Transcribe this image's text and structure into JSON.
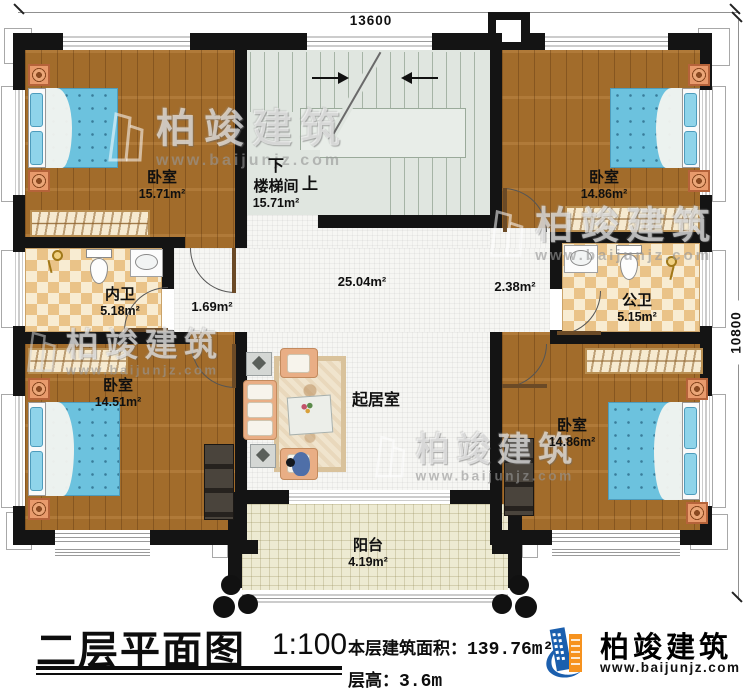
{
  "dimensions": {
    "width_top": "13600",
    "height_right": "10800"
  },
  "stair": {
    "down": "下",
    "up": "上"
  },
  "rooms": [
    {
      "id": "bedroom-top-left",
      "name": "卧室",
      "area": "15.71m²"
    },
    {
      "id": "staircase",
      "name": "楼梯间",
      "area": "15.71m²"
    },
    {
      "id": "bedroom-top-right",
      "name": "卧室",
      "area": "14.86m²"
    },
    {
      "id": "bathroom-private",
      "name": "内卫",
      "area": "5.18m²"
    },
    {
      "id": "bathroom-public",
      "name": "公卫",
      "area": "5.15m²"
    },
    {
      "id": "bedroom-bottom-left",
      "name": "卧室",
      "area": "14.51m²"
    },
    {
      "id": "bedroom-bottom-right",
      "name": "卧室",
      "area": "14.86m²"
    },
    {
      "id": "living-room",
      "name": "起居室",
      "area": ""
    },
    {
      "id": "balcony",
      "name": "阳台",
      "area": "4.19m²"
    }
  ],
  "hall_areas": {
    "left": "1.69m²",
    "right": "2.38m²",
    "center": "25.04m²"
  },
  "title_block": {
    "title": "二层平面图",
    "scale": "1:100",
    "floor_area_label": "本层建筑面积：",
    "floor_area_value": "139.76m²",
    "floor_height_label": "层高：",
    "floor_height_value": "3.6m"
  },
  "brand": {
    "name": "柏竣建筑",
    "website": "www.baijunjz.com"
  },
  "watermark": {
    "name": "柏竣建筑",
    "website": "www.baijunjz.com"
  },
  "colors": {
    "wall": "#141414",
    "wood_floor": "#ab722d",
    "tile_dark": "#eac388",
    "tile_light": "#f8ecd2",
    "bed_blue": "#6cc2de",
    "stair_floor": "#e0e6e0",
    "balcony_floor": "#edead2",
    "hall_floor": "#f6f6f3",
    "brand_blue": "#1b5fae",
    "brand_orange": "#f6921e"
  }
}
